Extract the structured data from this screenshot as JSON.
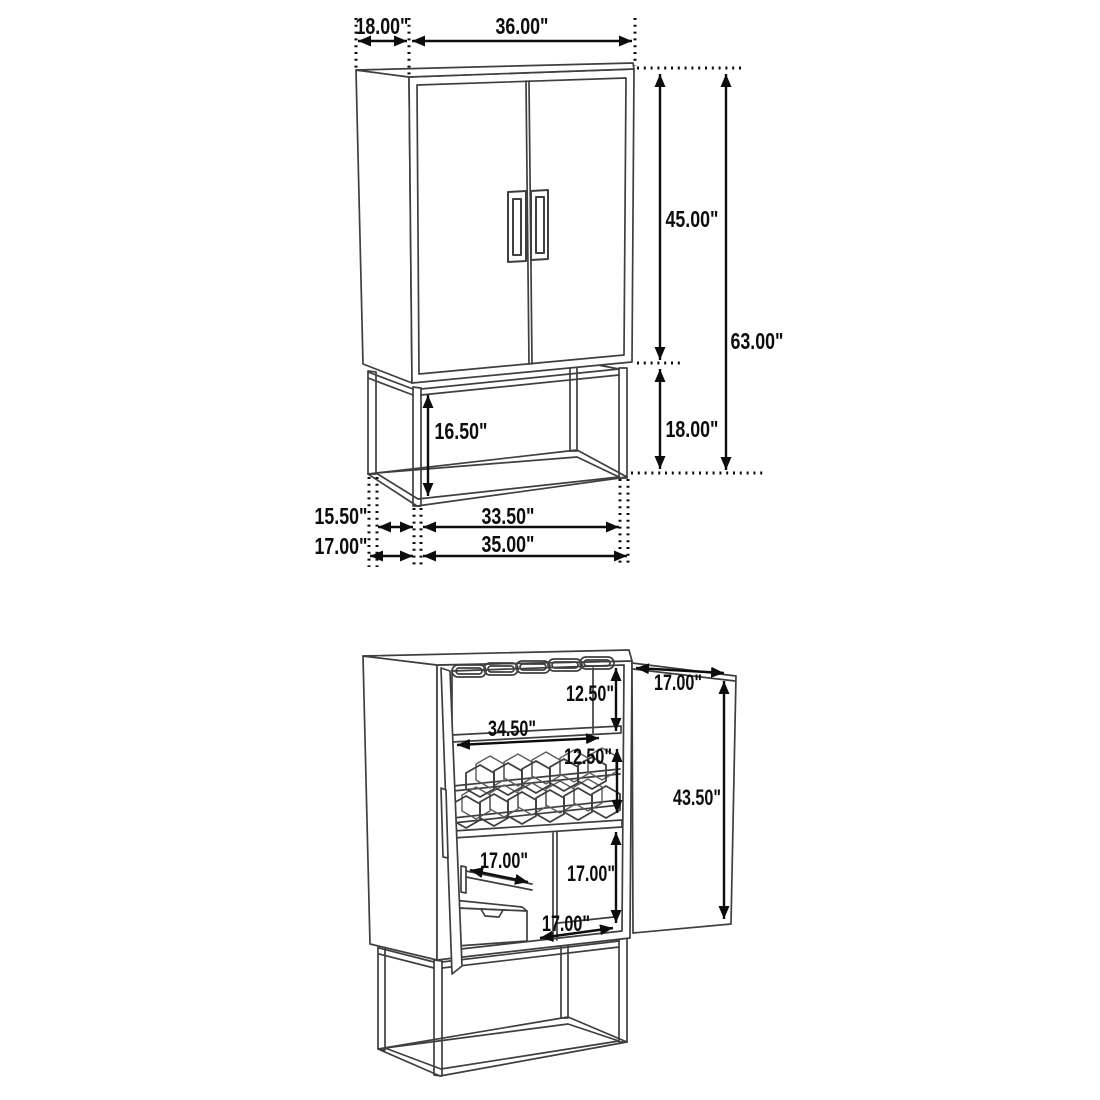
{
  "page": {
    "background": "#ffffff",
    "kind": "furniture dimension diagram",
    "subject": "bar wine cabinet with metal base"
  },
  "style": {
    "furniture_line_color": "#3f3f3f",
    "dimension_color": "#0d0d0d"
  },
  "closed_view": {
    "name": "closed cabinet with base - overall dimensions",
    "dims": {
      "top_depth": "18.00\"",
      "top_width": "36.00\"",
      "cabinet_height": "45.00\"",
      "overall_height": "63.00\"",
      "base_height": "18.00\"",
      "base_inner_height": "16.50\"",
      "base_inner_depth": "15.50\"",
      "base_inner_width": "33.50\"",
      "base_outer_depth": "17.00\"",
      "base_outer_width": "35.00\""
    }
  },
  "open_view": {
    "name": "open cabinet - interior dimensions",
    "dims": {
      "stemware_section_height": "12.50\"",
      "shelf_width": "34.50\"",
      "wine_rack_section_height": "12.50\"",
      "door_width": "17.00\"",
      "door_height": "43.50\"",
      "drawer_depth": "17.00\"",
      "lower_section_height": "17.00\"",
      "lower_section_width": "17.00\""
    }
  }
}
